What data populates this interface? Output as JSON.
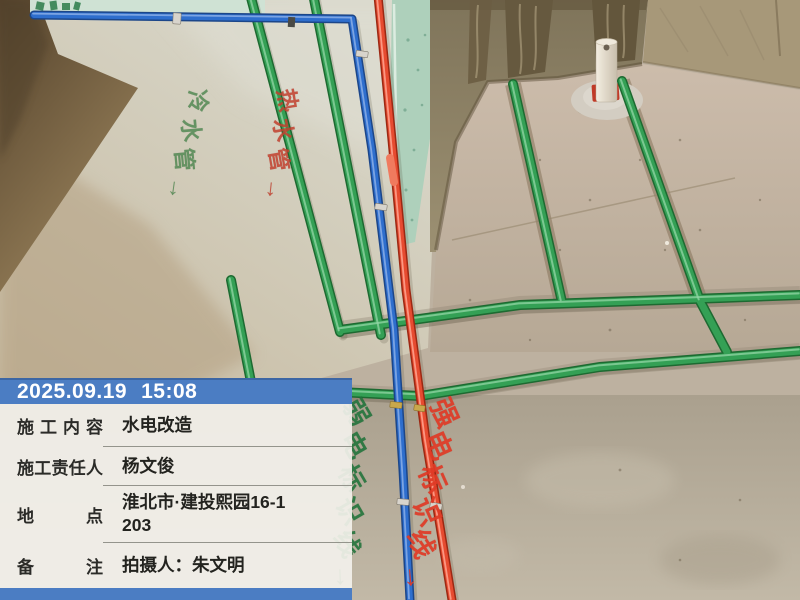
{
  "watermark": {
    "date": "2025.09.19",
    "time": "15:08",
    "bar_color": "#4b7dc3",
    "panel_background": "rgba(243,241,236,0.92)",
    "rows": [
      {
        "label": "施工内容",
        "value": "水电改造"
      },
      {
        "label": "施工责任人",
        "value": "杨文俊"
      },
      {
        "label": "地点",
        "value": "淮北市·建投熙园16-1\n203"
      },
      {
        "label": "备注",
        "value": "拍摄人：朱文明"
      }
    ]
  },
  "stencils": {
    "cold_water_pipe": "冷水管→",
    "hot_water_pipe": "热水管→",
    "weak_current_line": "弱电标识线→",
    "strong_current_line": "强电标识线→",
    "green_stencil_color": "#20733a",
    "red_stencil_color": "#e03a26"
  },
  "scene": {
    "pipe_colors": {
      "water_pipe_green": "#34a055",
      "conduit_blue": "#2e6ecd",
      "conduit_red": "#e64b30"
    },
    "objects": [
      "green-water-pipes",
      "blue-electric-conduit",
      "red-electric-conduit",
      "white-pvc-stub",
      "mint-wall-board",
      "concrete-column",
      "screed-floor"
    ]
  }
}
